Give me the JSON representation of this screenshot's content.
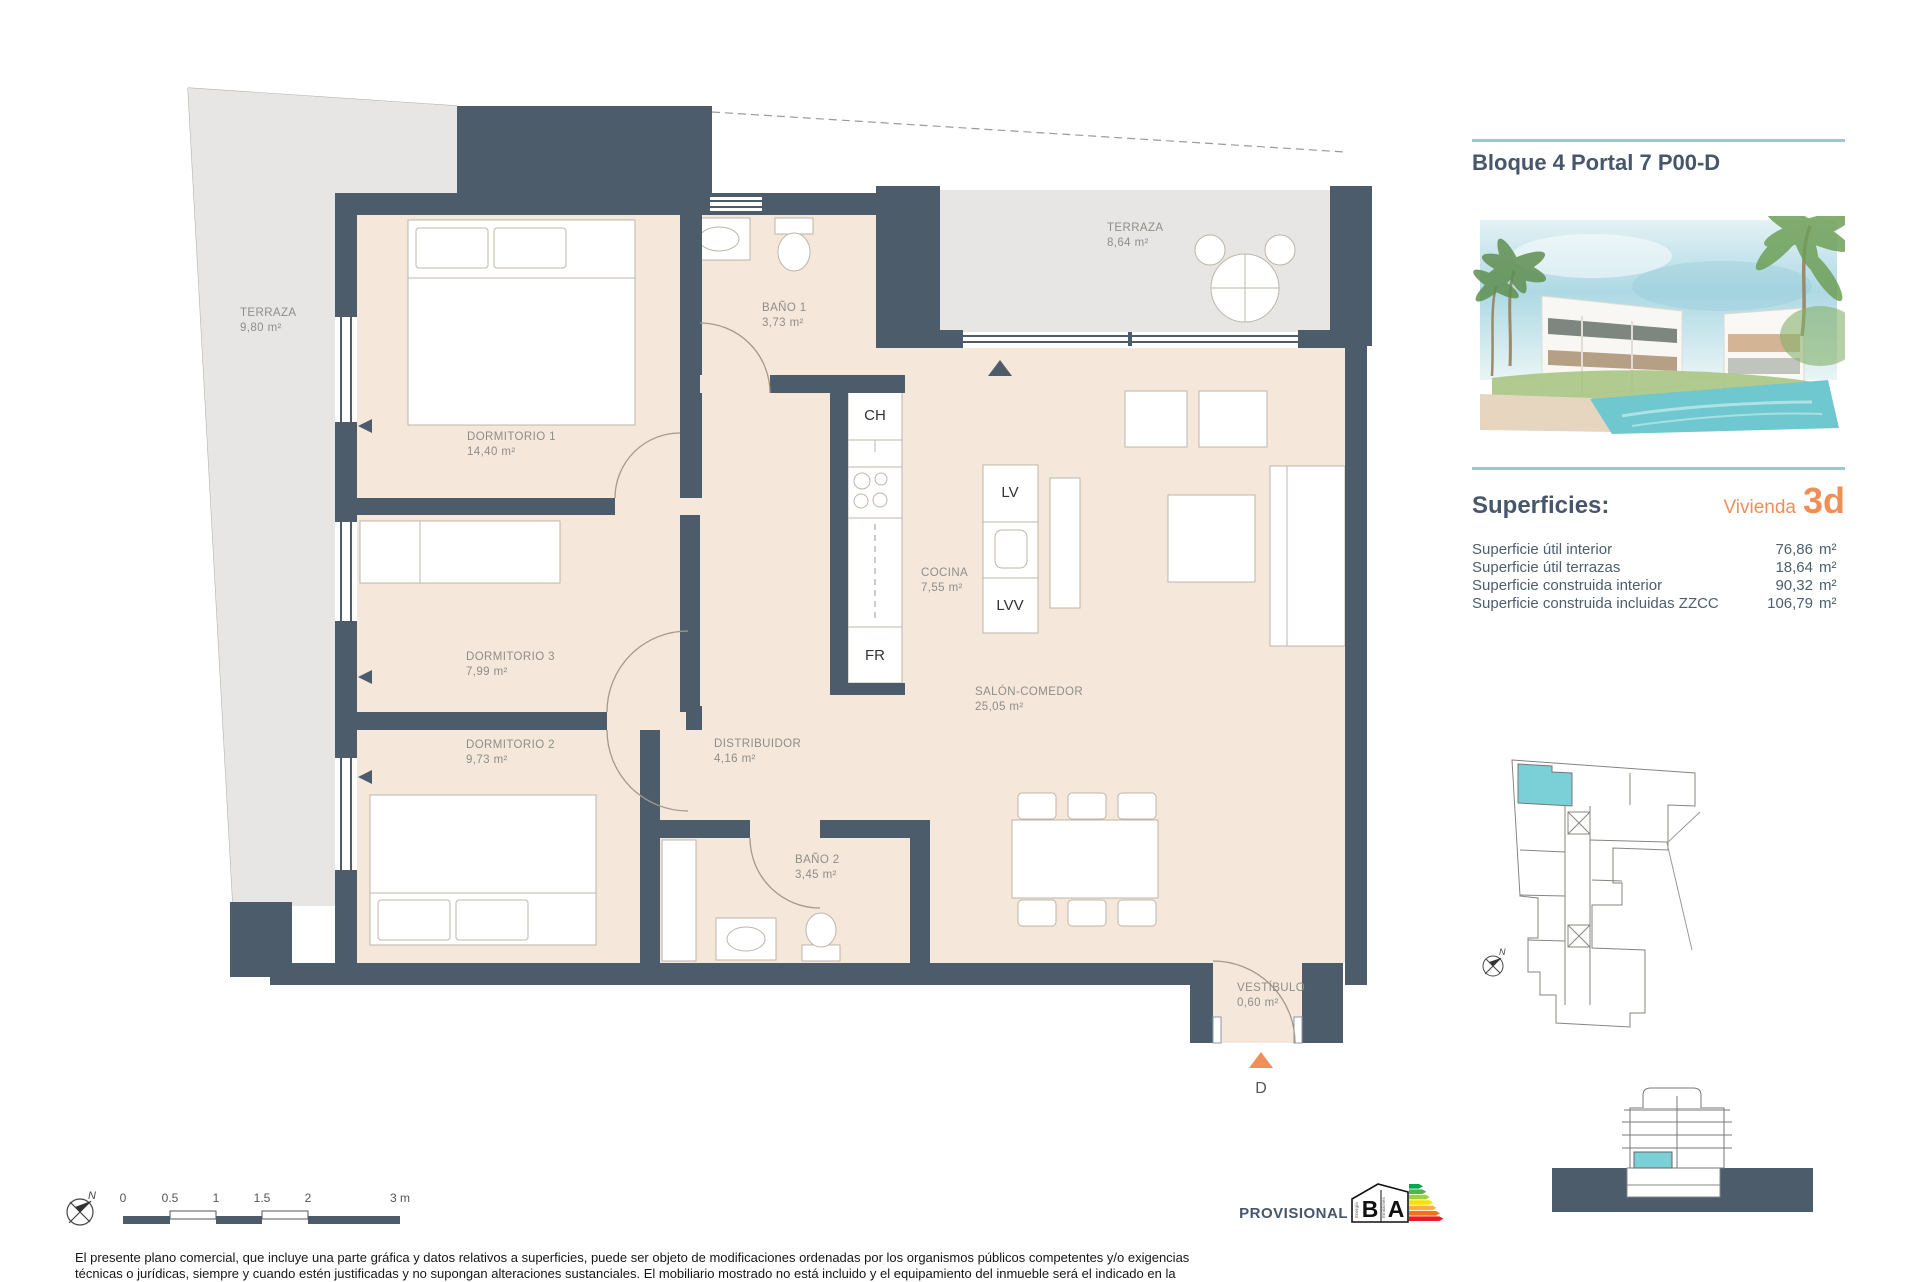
{
  "colors": {
    "wall": "#4d5c6a",
    "floor": "#f5e7da",
    "terrace": "#e7e6e4",
    "teal": "#7ad0d6",
    "teal_rule": "#8ecfd6",
    "orange": "#ef8f57",
    "title_blue": "#47566b",
    "label_gray": "#8e8e89"
  },
  "header": {
    "title": "Bloque 4 Portal 7 P00-D"
  },
  "superficies": {
    "heading": "Superficies:",
    "unit_label": "Vivienda",
    "unit_value": "3d",
    "rows": [
      {
        "label": "Superficie útil interior",
        "value": "76,86",
        "unit": "m²"
      },
      {
        "label": "Superficie útil terrazas",
        "value": "18,64",
        "unit": "m²"
      },
      {
        "label": "Superficie construida interior",
        "value": "90,32",
        "unit": "m²"
      },
      {
        "label": "Superficie construida incluidas ZZCC",
        "value": "106,79",
        "unit": "m²"
      }
    ]
  },
  "plan": {
    "rooms": [
      {
        "name": "DORMITORIO 1",
        "area": "14,40 m²"
      },
      {
        "name": "BAÑO 1",
        "area": "3,73 m²"
      },
      {
        "name": "DORMITORIO 3",
        "area": "7,99 m²"
      },
      {
        "name": "DORMITORIO 2",
        "area": "9,73 m²"
      },
      {
        "name": "DISTRIBUIDOR",
        "area": "4,16 m²"
      },
      {
        "name": "BAÑO 2",
        "area": "3,45 m²"
      },
      {
        "name": "COCINA",
        "area": "7,55 m²"
      },
      {
        "name": "SALÓN-COMEDOR",
        "area": "25,05 m²"
      },
      {
        "name": "VESTÍBULO",
        "area": "0,60 m²"
      },
      {
        "name": "TERRAZA",
        "area": "9,80 m²"
      },
      {
        "name": "TERRAZA",
        "area": "8,64 m²"
      }
    ],
    "fixtures": {
      "ch": "CH",
      "fr": "FR",
      "lv": "LV",
      "lvv": "LVV"
    },
    "entrance": {
      "label": "D"
    },
    "north": "N"
  },
  "scalebar": {
    "ticks": [
      "0",
      "0.5",
      "1",
      "1.5",
      "2",
      "3 m"
    ]
  },
  "footer": {
    "provisional": "PROVISIONAL",
    "energy": {
      "letter_left": "B",
      "letter_right": "A",
      "caption_left": "Energía",
      "caption_right": "Emisiones",
      "colors": [
        "#00a651",
        "#4db848",
        "#a5ce39",
        "#ffde00",
        "#fbb040",
        "#f36f21",
        "#ed1c24"
      ]
    },
    "disclaimer": [
      "El presente plano comercial, que incluye una parte gráfica y datos relativos a superficies, puede ser objeto de modificaciones ordenadas por los organismos públicos competentes y/o exigencias",
      "técnicas o jurídicas, siempre y cuando estén justificadas y no supongan alteraciones sustanciales. El mobiliario mostrado no está incluido y el equipamiento del inmueble será el indicado en la"
    ]
  }
}
